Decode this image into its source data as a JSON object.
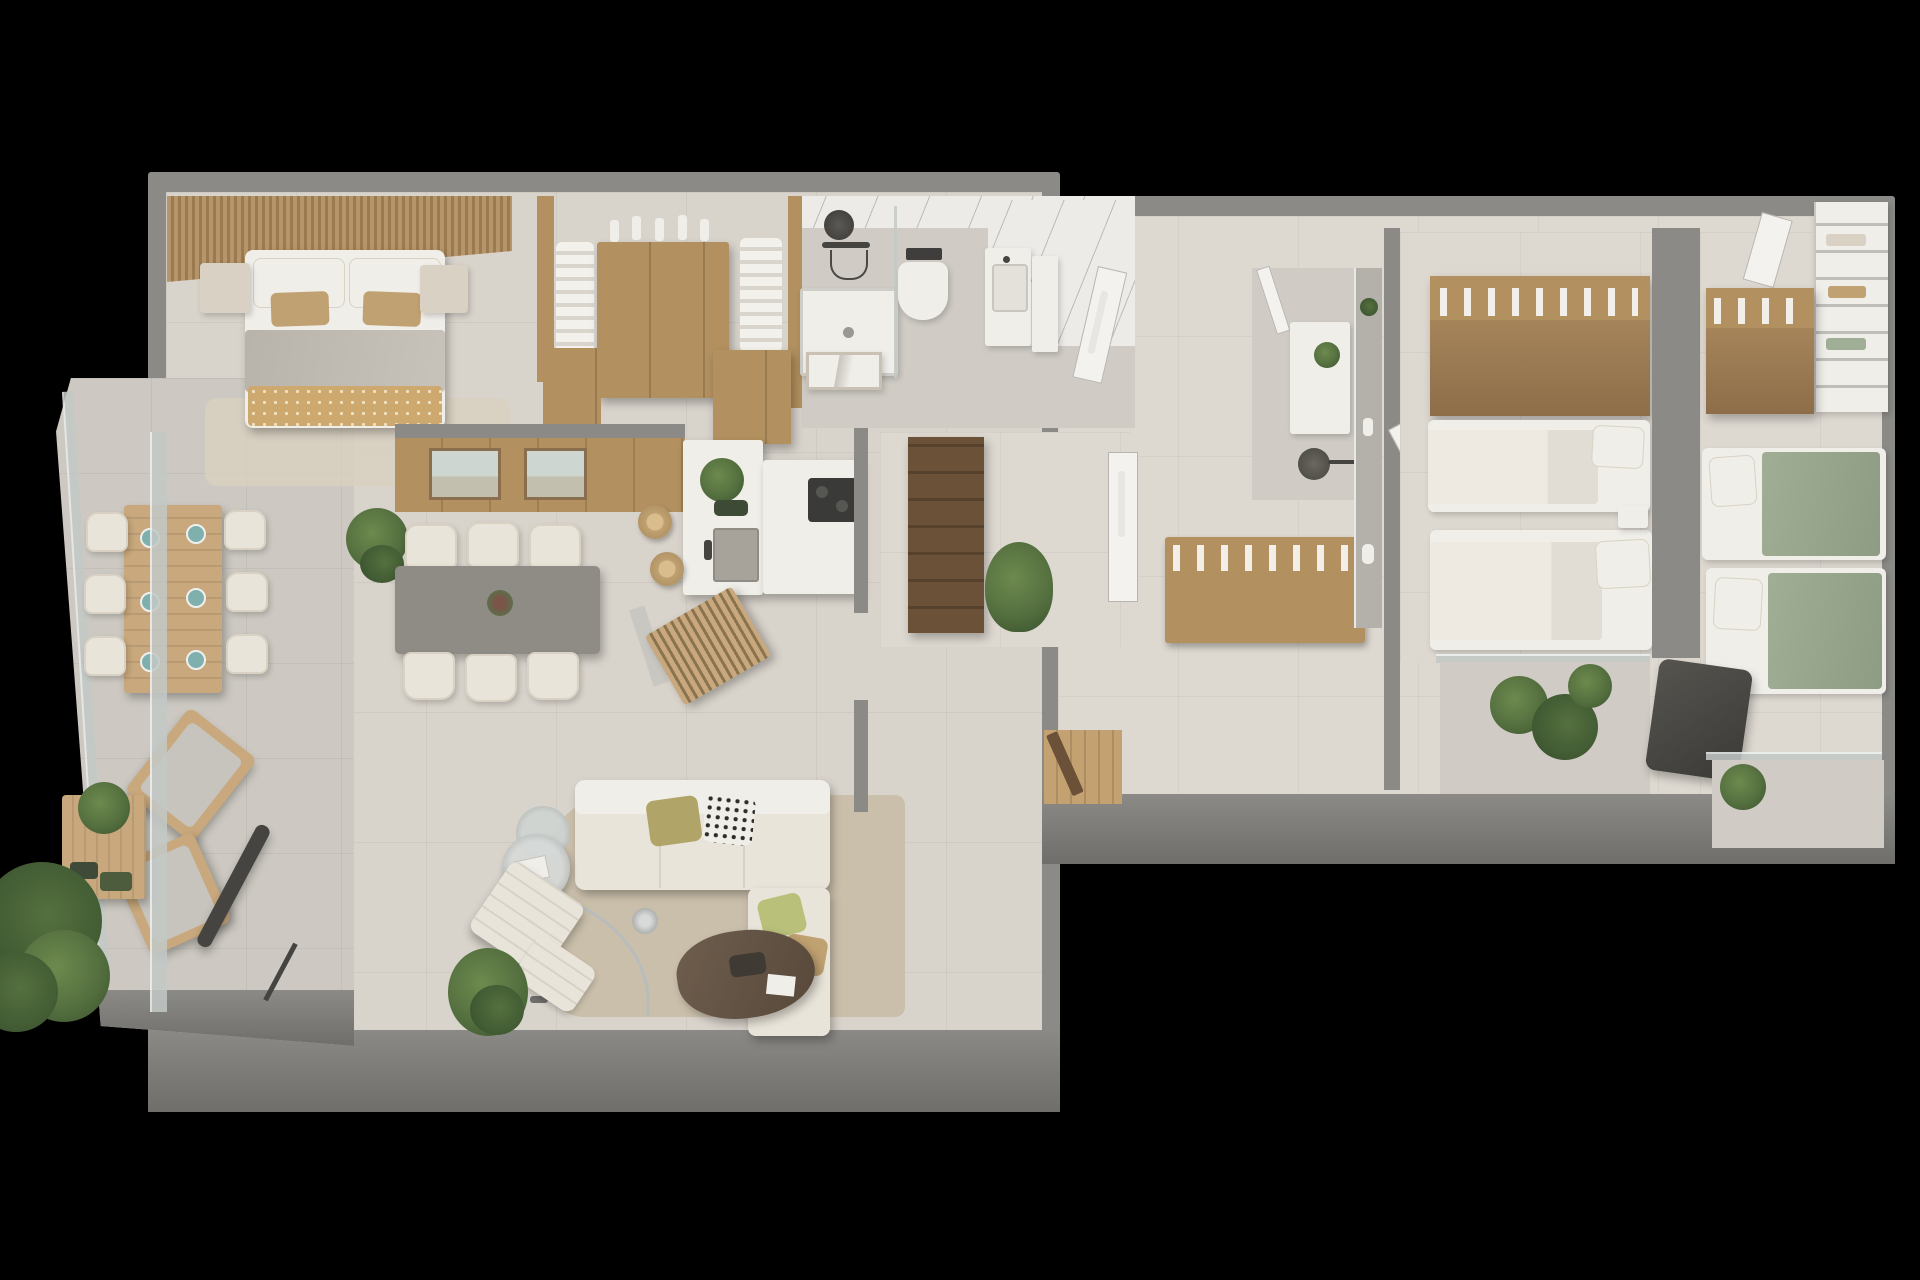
{
  "scene": {
    "title": "3D apartment floor plan render",
    "view": "top-down axonometric",
    "background": "black",
    "visible_text": "none"
  },
  "palette": {
    "bg": "#000000",
    "wall": "#8b8a86",
    "wallDark": "#6f6e6a",
    "floorMain": "#d8d3cb",
    "floorWarm": "#ddd8d0",
    "floorBath": "#d0ccc5",
    "floorTerrace": "#cdc9c2",
    "rug": "#c9bca7",
    "rugLight": "#d9d0bf",
    "wood": "#b2905f",
    "woodLight": "#c8a87c",
    "woodDark": "#6b5138",
    "woodFloor": "#c4a171",
    "slat": "#b7956a",
    "slatDark": "#9a7a50",
    "white": "#f0eee9",
    "cream": "#e9e4d9",
    "creamShade": "#d9d2c4",
    "greyFurn": "#8f8c86",
    "duvet": "#b8b3ab",
    "woven": "#cda96f",
    "tan": "#c0a171",
    "olive": "#b0a468",
    "sage": "#9fae94",
    "teal": "#7fb0ad",
    "plant": "#55703f",
    "plantDark": "#3c5530",
    "plantLight": "#6d8a4e",
    "marble": "#edebe7",
    "glass": "#c3c9c7",
    "dark": "#454441",
    "chrome": "#b9bcbd",
    "artSky": "#cdd6d0"
  },
  "rooms": [
    {
      "name": "terrace",
      "furniture": [
        "outdoor dining table",
        "6 outdoor chairs",
        "teal place settings",
        "2 wooden lounge chairs",
        "low wooden coffee table",
        "potted plants",
        "closed parasol",
        "glass balustrade"
      ]
    },
    {
      "name": "master-bedroom",
      "furniture": [
        "double bed",
        "wood slat headboard wall",
        "2 nightstands",
        "grey throw",
        "woven blanket",
        "rug"
      ]
    },
    {
      "name": "walk-in-closet",
      "furniture": [
        "hanging clothes rails",
        "wood island dresser",
        "perfume bottles"
      ]
    },
    {
      "name": "master-bathroom",
      "furniture": [
        "marble walk-in shower",
        "rain shower head",
        "shower tray",
        "wall-hung toilet",
        "vanity basin",
        "leaning framed art",
        "glass screen"
      ]
    },
    {
      "name": "utility-room",
      "furniture": [
        "dark wood shelving",
        "potted plant",
        "door with towel"
      ]
    },
    {
      "name": "kitchen",
      "furniture": [
        "white island with sink",
        "cooktop",
        "herb planter",
        "2 rattan bar stools",
        "tall wood cabinets"
      ]
    },
    {
      "name": "dining-area",
      "furniture": [
        "grey dining table",
        "6 cream chairs",
        "vase with flowers",
        "wood panel wall",
        "2 framed landscape artworks",
        "monstera plant"
      ]
    },
    {
      "name": "living-room",
      "furniture": [
        "cream corner sofa",
        "olive cushion",
        "patterned cushion",
        "2 round glass side tables",
        "organic dark wood coffee table",
        "arc floor lamp",
        "lounge chair with ottoman",
        "palm plant",
        "beige rug",
        "slatted wood console"
      ]
    },
    {
      "name": "hallway",
      "furniture": [
        "coat closet with hangers",
        "entrance door",
        "wood doormat",
        "display shelf with vases"
      ]
    },
    {
      "name": "bathroom-2",
      "furniture": [
        "white vanity",
        "round dark basin",
        "small plant",
        "door"
      ]
    },
    {
      "name": "bedroom-2",
      "furniture": [
        "wardrobe with hanging clothes",
        "2 single beds",
        "white pillows",
        "nightstand",
        "balcony with plants"
      ]
    },
    {
      "name": "bedroom-3",
      "furniture": [
        "white shelving closet",
        "wardrobe with hanging clothes",
        "2 single beds with sage throws",
        "dark armchair",
        "balcony plant"
      ]
    }
  ]
}
